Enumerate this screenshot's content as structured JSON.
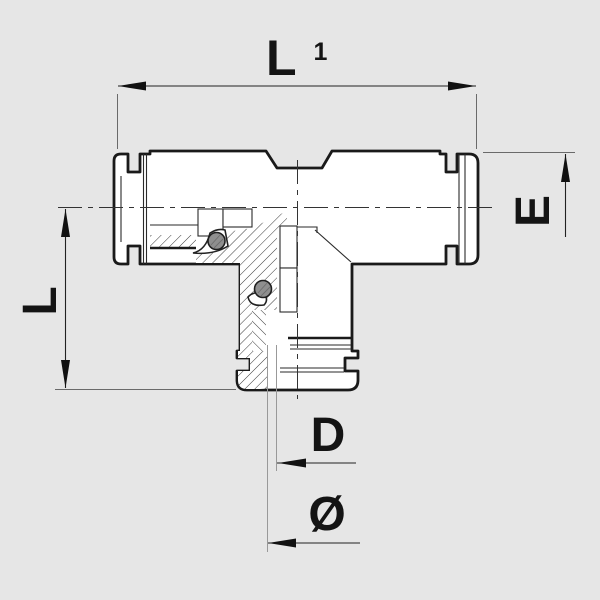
{
  "drawing": {
    "type": "technical-section-drawing",
    "subject": "push-in-tee-fitting-cross-section",
    "colors": {
      "background": "#e6e6e6",
      "outline": "#1a1a1a",
      "thin_line": "#2a2a2a",
      "extension_line": "#8a8a8a",
      "oring_fill": "#8f8f8f"
    },
    "labels": {
      "l1": {
        "base": "L",
        "sub": "1"
      },
      "e": "E",
      "l": "L",
      "d": "D",
      "diameter": "Ø"
    }
  }
}
